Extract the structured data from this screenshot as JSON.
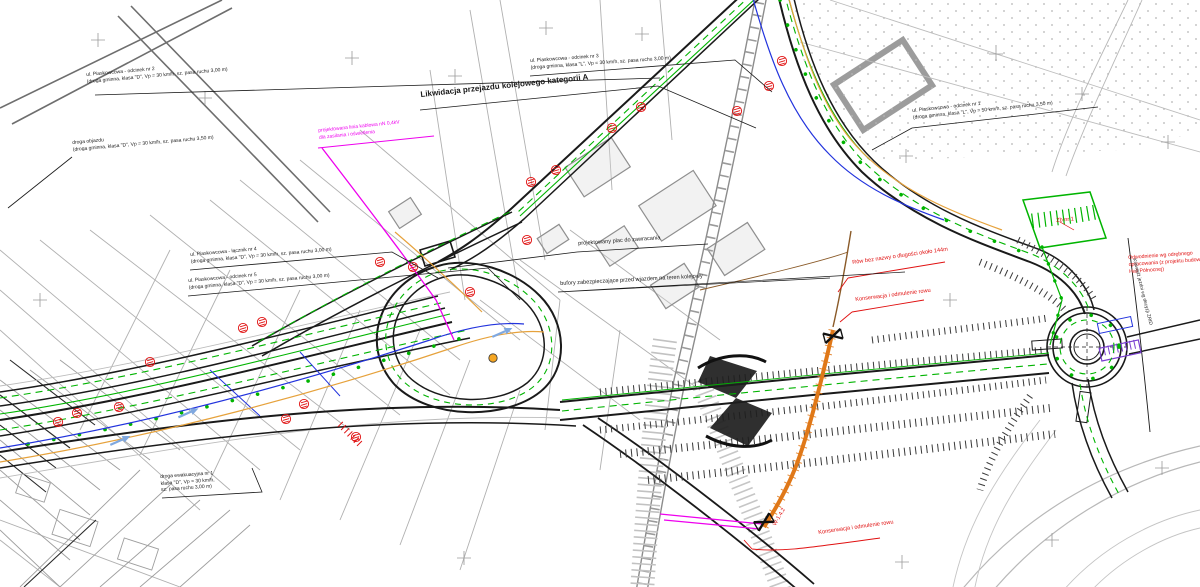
{
  "drawing": {
    "kind": "road-construction-site-plan",
    "language": "pl"
  },
  "colors": {
    "design_black": "#1a1a1a",
    "basemap_grey": "#a9a9a9",
    "marking_green": "#00b400",
    "annotation_red": "#e01010",
    "cable_magenta": "#ee00ee",
    "cable_blue": "#2233dd",
    "gas_orange": "#e6a23c",
    "ditch_orange": "#e07818",
    "ditch_brown": "#8a5a28",
    "area_violet": "#7a3fd0"
  },
  "labels": {
    "likwidacja": "Likwidacja przejazdu kolejowego kategorii A",
    "odcinek1": "ul. Piaskowcowa - odcinek nr 1\n(droga gminna, klasa \"L\", Vp = 50 km/h, sz. pasa ruchu 3,50 m)",
    "odcinek2": "ul. Piaskowcowa - odcinek nr 2\n(droga gminna, klasa \"D\", Vp = 30 km/h, sz. pasa ruchu 3,00 m)",
    "odcinek3": "ul. Piaskowcowa - odcinek nr 3\n(droga gminna, klasa \"L\", Vp = 30 km/h, sz. pasa ruchu 3,00 m)",
    "lacznik4": "ul. Piaskowcowa - łącznik nr 4\n(droga gminna, klasa \"D\", Vp = 30 km/h, sz. pasa ruchu 3,00 m)",
    "odcinek5": "ul. Piaskowcowa - odcinek nr 5\n(droga gminna, klasa \"D\", Vp = 30 km/h, sz. pasa ruchu 3,00 m)",
    "objazd": "droga objazdu\n(droga gminna, klasa \"D\", Vp = 30 km/h, sz. pasa ruchu 3,50 m)",
    "plac": "projektowany plac do zawracania",
    "bufory": "bufory zabezpieczające przed wjazdem na teren kolejowy",
    "ewakuacyjna": "droga ewakuacyjna nr 1\nklasa \"D\", Vp = 30 km/h,\nsz. pasa ruchu 3,00 m)",
    "kablowa": "projektowana linia kablowa nN 0,4kV\ndla zasilania i oświetlenia",
    "row_bez_nazwy": "Rów bez nazwy o długości około 144m",
    "konserwacja_rowu_1": "Konserwacja i odmulenie rowu",
    "konserwacja_rowu_2": "Konserwacja i odmulenie rowu",
    "w142": "W-1.4.2",
    "zbiornik": "Zb nr 1",
    "odwodnienie": "Odwodnienie wg odrębnego\nopracowania (z projektu budowy\nHali Północnej)",
    "krawedz": "Krawędź jezdni wg decyzji ZRID"
  },
  "symbols": {
    "survey_point": "red hatched circle benchmark",
    "grid_cross": "grey coordinate-grid cross",
    "flow_arrow": "blue flow-direction arrow",
    "culvert_marker": "black bow-tie culvert headwall"
  }
}
